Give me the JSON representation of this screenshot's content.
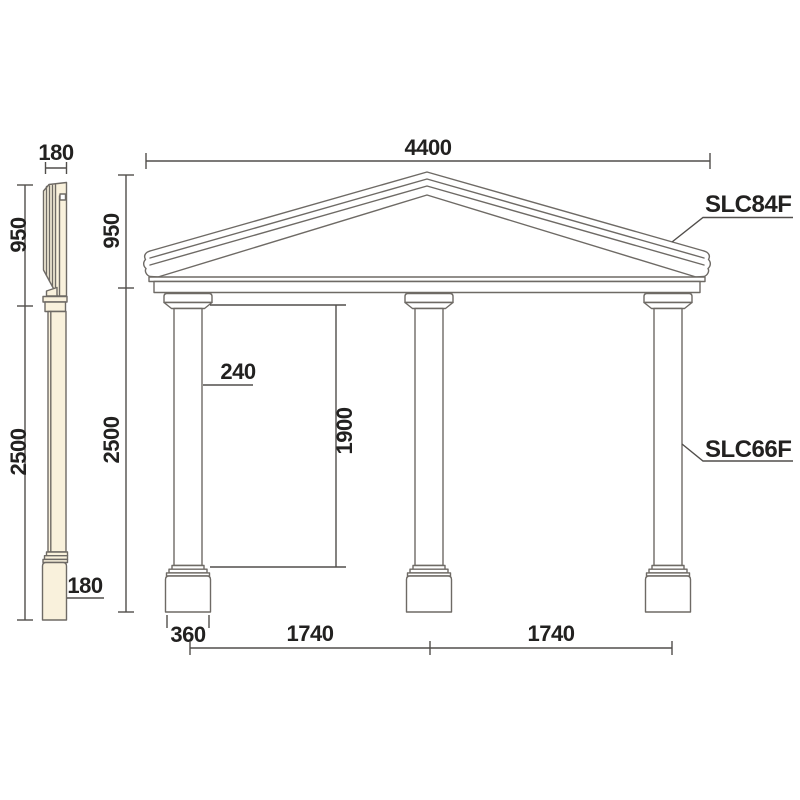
{
  "drawing": {
    "type": "architectural-dimension-drawing",
    "background_color": "#ffffff",
    "line_color": "#6e6a65",
    "dimension_line_color": "#514e4b",
    "text_color": "#222120",
    "side_profile_fill_color": "#f9f1dc",
    "side_profile": {
      "top_width_label": "180",
      "pediment_height_label": "950",
      "column_height_label": "2500",
      "base_depth_label": "180"
    },
    "front_elevation": {
      "overall_width_label": "4400",
      "pediment_height_label": "950",
      "column_height_label": "2500",
      "shaft_width_label": "240",
      "clear_opening_height_label": "1900",
      "plinth_width_label": "360",
      "bay_spacing_left_label": "1740",
      "bay_spacing_right_label": "1740",
      "pediment_part_code": "SLC84F",
      "column_part_code": "SLC66F"
    }
  }
}
